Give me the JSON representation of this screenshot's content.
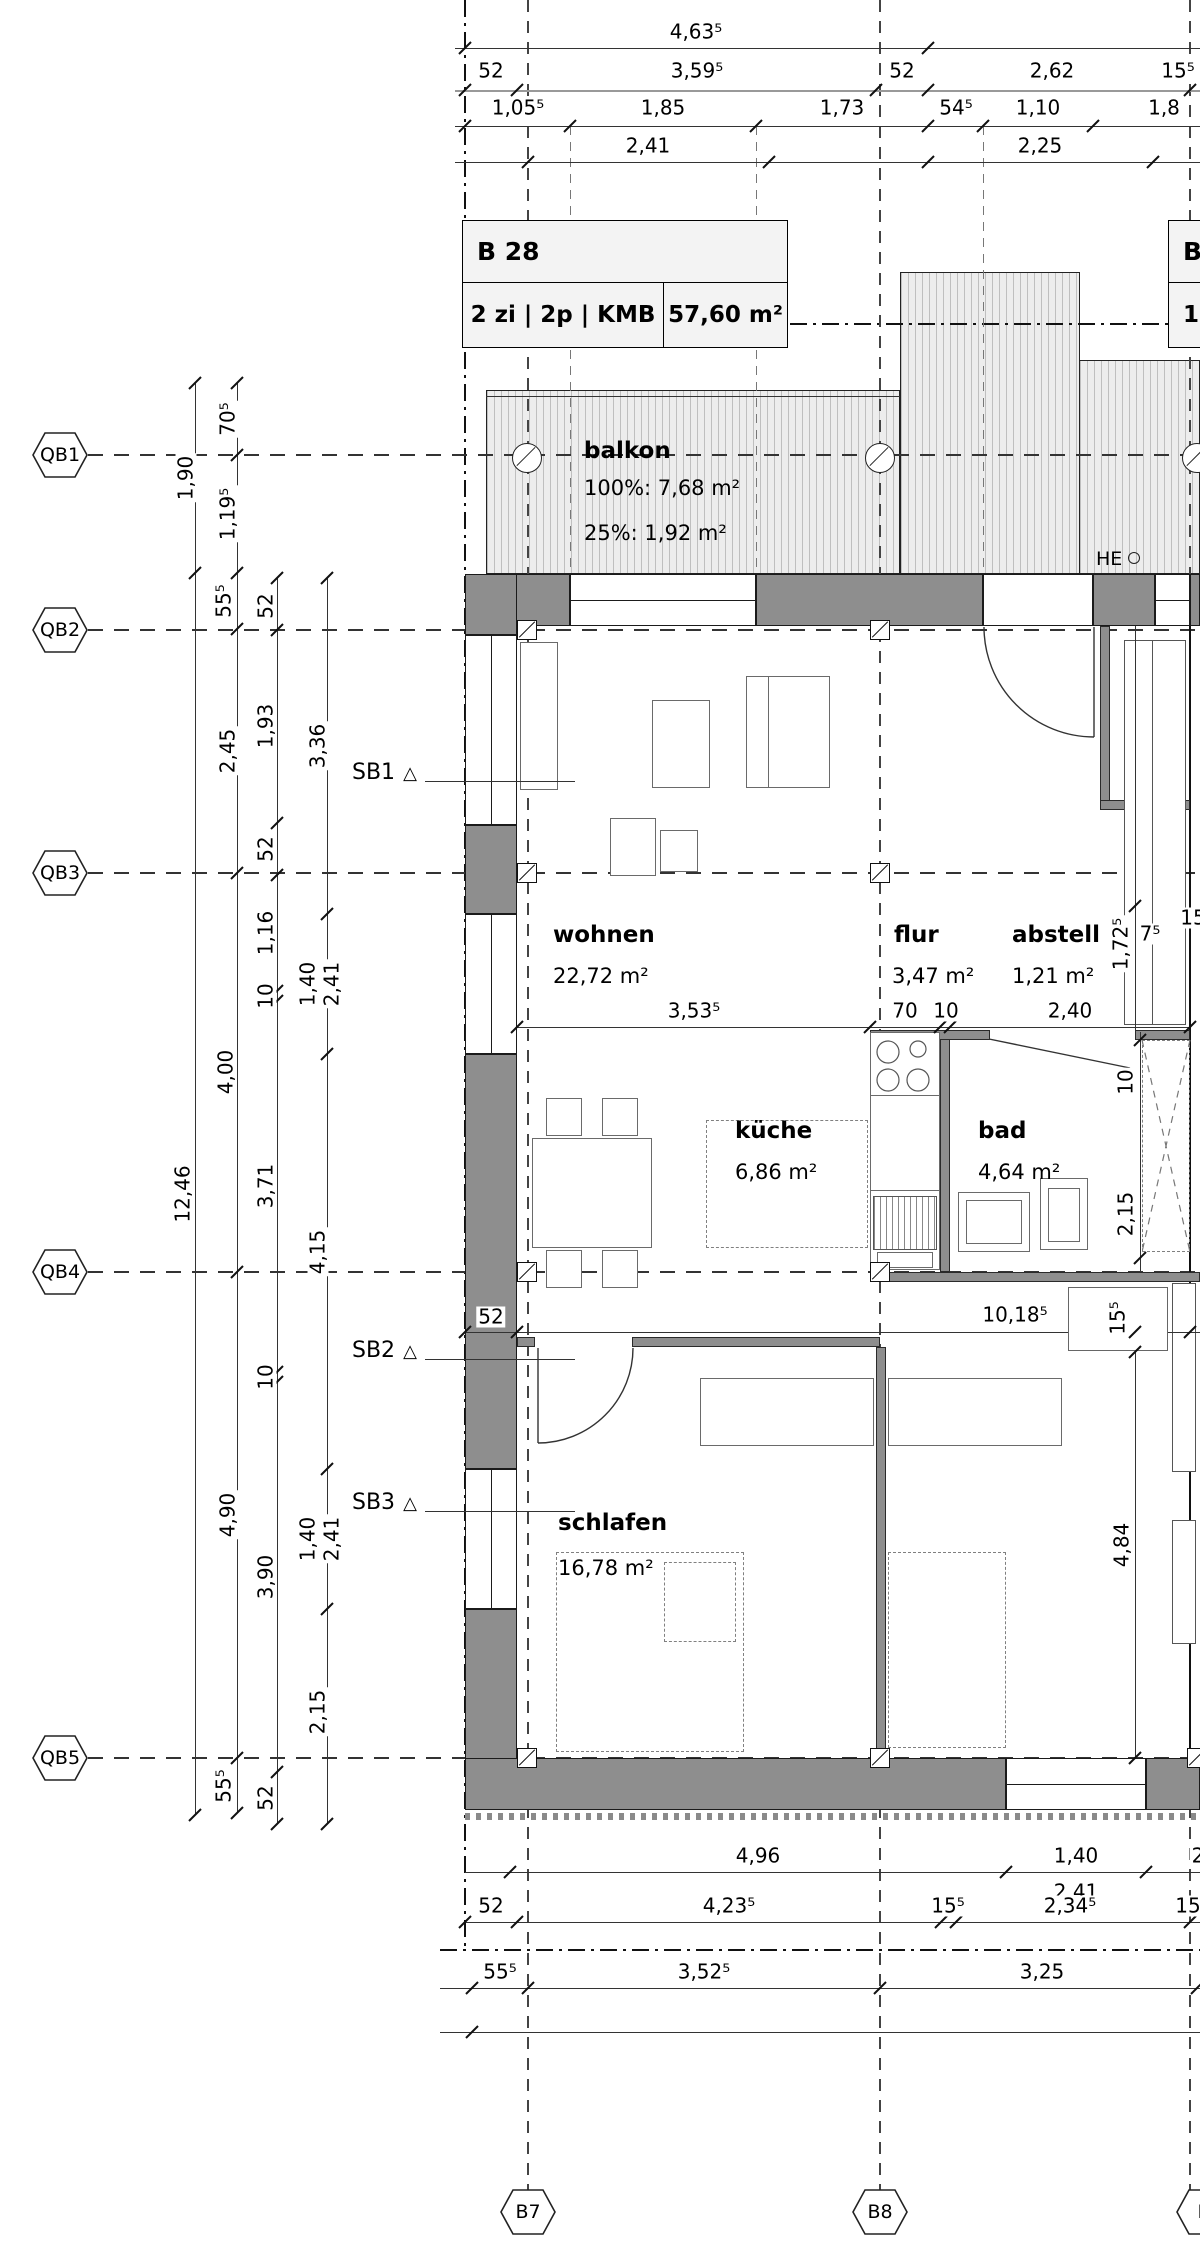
{
  "title_blocks": {
    "b28": {
      "name": "B 28",
      "spec": "2 zi | 2p | KMB",
      "area": "57,60 m²"
    },
    "right": {
      "name": "B",
      "spec": "1 z"
    }
  },
  "rooms": {
    "balkon": {
      "name": "balkon",
      "area_100": "100%: 7,68 m²",
      "area_25": "25%: 1,92 m²"
    },
    "wohnen": {
      "name": "wohnen",
      "area": "22,72 m²"
    },
    "flur": {
      "name": "flur",
      "area": "3,47 m²"
    },
    "abstell": {
      "name": "abstell",
      "area": "1,21 m²"
    },
    "kueche": {
      "name": "küche",
      "area": "6,86 m²"
    },
    "bad": {
      "name": "bad",
      "area": "4,64 m²"
    },
    "schlafen": {
      "name": "schlafen",
      "area": "16,78 m²"
    },
    "he_label": "HE"
  },
  "grid_markers_left": [
    {
      "t": "QB1",
      "x": 60,
      "y": 455
    },
    {
      "t": "QB2",
      "x": 60,
      "y": 630
    },
    {
      "t": "QB3",
      "x": 60,
      "y": 873
    },
    {
      "t": "QB4",
      "x": 60,
      "y": 1272
    },
    {
      "t": "QB5",
      "x": 60,
      "y": 1758
    }
  ],
  "grid_markers_bottom": [
    {
      "t": "B7",
      "x": 528,
      "y": 2212
    },
    {
      "t": "B8",
      "x": 880,
      "y": 2212
    },
    {
      "t": "B",
      "x": 1204,
      "y": 2212
    }
  ],
  "section_markers": [
    {
      "t": "SB1",
      "x": 352,
      "y": 760
    },
    {
      "t": "SB2",
      "x": 352,
      "y": 1338
    },
    {
      "t": "SB3",
      "x": 352,
      "y": 1490
    }
  ],
  "dims_top": [
    {
      "t": "4,63⁵",
      "x": 696,
      "y": 32
    },
    {
      "t": "52",
      "x": 491,
      "y": 71
    },
    {
      "t": "3,59⁵",
      "x": 697,
      "y": 71
    },
    {
      "t": "52",
      "x": 902,
      "y": 71
    },
    {
      "t": "2,62",
      "x": 1052,
      "y": 71
    },
    {
      "t": "15⁵",
      "x": 1178,
      "y": 71
    },
    {
      "t": "1,05⁵",
      "x": 518,
      "y": 108
    },
    {
      "t": "1,85",
      "x": 663,
      "y": 108
    },
    {
      "t": "1,73",
      "x": 842,
      "y": 108
    },
    {
      "t": "54⁵",
      "x": 956,
      "y": 108
    },
    {
      "t": "1,10",
      "x": 1038,
      "y": 108
    },
    {
      "t": "1,8",
      "x": 1164,
      "y": 108
    },
    {
      "t": "2,41",
      "x": 648,
      "y": 146
    },
    {
      "t": "2,25",
      "x": 1040,
      "y": 146
    }
  ],
  "dims_left": [
    {
      "t": "1,90",
      "x": 186,
      "y": 478,
      "rot": true
    },
    {
      "t": "70⁵",
      "x": 228,
      "y": 419,
      "rot": true
    },
    {
      "t": "1,19⁵",
      "x": 228,
      "y": 514,
      "rot": true
    },
    {
      "t": "55⁵",
      "x": 224,
      "y": 601,
      "rot": true
    },
    {
      "t": "52",
      "x": 266,
      "y": 606,
      "rot": true
    },
    {
      "t": "2,45",
      "x": 228,
      "y": 751,
      "rot": true
    },
    {
      "t": "1,93",
      "x": 266,
      "y": 726,
      "rot": true
    },
    {
      "t": "3,36",
      "x": 318,
      "y": 746,
      "rot": true
    },
    {
      "t": "52",
      "x": 266,
      "y": 849,
      "rot": true
    },
    {
      "t": "1,16",
      "x": 266,
      "y": 933,
      "rot": true
    },
    {
      "t": "10",
      "x": 266,
      "y": 996,
      "rot": true
    },
    {
      "t": "1,40",
      "x": 308,
      "y": 984,
      "rot": true
    },
    {
      "t": "2,41",
      "x": 332,
      "y": 984,
      "rot": true
    },
    {
      "t": "4,00",
      "x": 226,
      "y": 1072,
      "rot": true
    },
    {
      "t": "12,46",
      "x": 183,
      "y": 1194,
      "rot": true
    },
    {
      "t": "3,71",
      "x": 266,
      "y": 1186,
      "rot": true
    },
    {
      "t": "4,15",
      "x": 318,
      "y": 1252,
      "rot": true
    },
    {
      "t": "10",
      "x": 266,
      "y": 1377,
      "rot": true
    },
    {
      "t": "4,90",
      "x": 228,
      "y": 1515,
      "rot": true
    },
    {
      "t": "1,40",
      "x": 308,
      "y": 1539,
      "rot": true
    },
    {
      "t": "2,41",
      "x": 332,
      "y": 1539,
      "rot": true
    },
    {
      "t": "3,90",
      "x": 266,
      "y": 1577,
      "rot": true
    },
    {
      "t": "2,15",
      "x": 318,
      "y": 1712,
      "rot": true
    },
    {
      "t": "55⁵",
      "x": 224,
      "y": 1786,
      "rot": true
    },
    {
      "t": "52",
      "x": 266,
      "y": 1798,
      "rot": true
    }
  ],
  "dims_inner": [
    {
      "t": "3,53⁵",
      "x": 694,
      "y": 1011
    },
    {
      "t": "70",
      "x": 905,
      "y": 1011
    },
    {
      "t": "10",
      "x": 946,
      "y": 1011
    },
    {
      "t": "2,40",
      "x": 1070,
      "y": 1011
    },
    {
      "t": "52",
      "x": 491,
      "y": 1317
    },
    {
      "t": "10,18⁵",
      "x": 1015,
      "y": 1315
    },
    {
      "t": "15⁵",
      "x": 1118,
      "y": 1318,
      "rot": true
    },
    {
      "t": "1,72⁵",
      "x": 1121,
      "y": 944,
      "rot": true
    },
    {
      "t": "7⁵",
      "x": 1150,
      "y": 934
    },
    {
      "t": "15⁵",
      "x": 1197,
      "y": 918
    },
    {
      "t": "10",
      "x": 1126,
      "y": 1082,
      "rot": true
    },
    {
      "t": "2,15",
      "x": 1126,
      "y": 1214,
      "rot": true
    },
    {
      "t": "4,84",
      "x": 1122,
      "y": 1545,
      "rot": true
    }
  ],
  "dims_bottom": [
    {
      "t": "4,96",
      "x": 758,
      "y": 1856
    },
    {
      "t": "1,40",
      "x": 1076,
      "y": 1856
    },
    {
      "t": "2",
      "x": 1198,
      "y": 1856
    },
    {
      "t": "2,41",
      "x": 1076,
      "y": 1892
    },
    {
      "t": "52",
      "x": 491,
      "y": 1906
    },
    {
      "t": "4,23⁵",
      "x": 729,
      "y": 1906
    },
    {
      "t": "15⁵",
      "x": 948,
      "y": 1906
    },
    {
      "t": "2,34⁵",
      "x": 1070,
      "y": 1906
    },
    {
      "t": "15⁵",
      "x": 1192,
      "y": 1906
    },
    {
      "t": "55⁵",
      "x": 500,
      "y": 1972
    },
    {
      "t": "3,52⁵",
      "x": 704,
      "y": 1972
    },
    {
      "t": "3,25",
      "x": 1042,
      "y": 1972
    }
  ],
  "ticks": [
    {
      "x": 465,
      "y": 48
    },
    {
      "x": 928,
      "y": 48
    },
    {
      "x": 465,
      "y": 90
    },
    {
      "x": 517,
      "y": 90
    },
    {
      "x": 876,
      "y": 90
    },
    {
      "x": 928,
      "y": 90
    },
    {
      "x": 1190,
      "y": 90
    },
    {
      "x": 465,
      "y": 126
    },
    {
      "x": 570,
      "y": 126
    },
    {
      "x": 756,
      "y": 126
    },
    {
      "x": 928,
      "y": 126
    },
    {
      "x": 983,
      "y": 126
    },
    {
      "x": 1093,
      "y": 126
    },
    {
      "x": 528,
      "y": 162
    },
    {
      "x": 769,
      "y": 162
    },
    {
      "x": 928,
      "y": 162
    },
    {
      "x": 1153,
      "y": 162
    },
    {
      "x": 195,
      "y": 383
    },
    {
      "x": 195,
      "y": 573
    },
    {
      "x": 195,
      "y": 1815
    },
    {
      "x": 237,
      "y": 383
    },
    {
      "x": 237,
      "y": 455
    },
    {
      "x": 237,
      "y": 573
    },
    {
      "x": 237,
      "y": 629
    },
    {
      "x": 237,
      "y": 873
    },
    {
      "x": 237,
      "y": 1272
    },
    {
      "x": 237,
      "y": 1758
    },
    {
      "x": 237,
      "y": 1813
    },
    {
      "x": 277,
      "y": 578
    },
    {
      "x": 277,
      "y": 630
    },
    {
      "x": 277,
      "y": 823
    },
    {
      "x": 277,
      "y": 875
    },
    {
      "x": 277,
      "y": 991
    },
    {
      "x": 277,
      "y": 1001
    },
    {
      "x": 277,
      "y": 1372
    },
    {
      "x": 277,
      "y": 1382
    },
    {
      "x": 277,
      "y": 1772
    },
    {
      "x": 277,
      "y": 1824
    },
    {
      "x": 327,
      "y": 578
    },
    {
      "x": 327,
      "y": 914
    },
    {
      "x": 327,
      "y": 1054
    },
    {
      "x": 327,
      "y": 1469
    },
    {
      "x": 327,
      "y": 1609
    },
    {
      "x": 327,
      "y": 1824
    },
    {
      "x": 517,
      "y": 1027
    },
    {
      "x": 870,
      "y": 1027
    },
    {
      "x": 940,
      "y": 1027
    },
    {
      "x": 950,
      "y": 1027
    },
    {
      "x": 1190,
      "y": 1027
    },
    {
      "x": 465,
      "y": 1332
    },
    {
      "x": 517,
      "y": 1332
    },
    {
      "x": 1135,
      "y": 1332
    },
    {
      "x": 1190,
      "y": 1332
    },
    {
      "x": 1140,
      "y": 1040
    },
    {
      "x": 1140,
      "y": 1258
    },
    {
      "x": 1135,
      "y": 906
    },
    {
      "x": 1135,
      "y": 1352
    },
    {
      "x": 1135,
      "y": 1758
    },
    {
      "x": 510,
      "y": 1872
    },
    {
      "x": 1006,
      "y": 1872
    },
    {
      "x": 1146,
      "y": 1872
    },
    {
      "x": 465,
      "y": 1922
    },
    {
      "x": 517,
      "y": 1922
    },
    {
      "x": 941,
      "y": 1922
    },
    {
      "x": 956,
      "y": 1922
    },
    {
      "x": 1190,
      "y": 1922
    },
    {
      "x": 472,
      "y": 1988
    },
    {
      "x": 528,
      "y": 1988
    },
    {
      "x": 880,
      "y": 1988
    },
    {
      "x": 1197,
      "y": 1988
    },
    {
      "x": 472,
      "y": 2032
    }
  ],
  "columns": [
    {
      "x": 527,
      "y": 630
    },
    {
      "x": 880,
      "y": 630
    },
    {
      "x": 527,
      "y": 873
    },
    {
      "x": 880,
      "y": 873
    },
    {
      "x": 527,
      "y": 1272
    },
    {
      "x": 880,
      "y": 1272
    },
    {
      "x": 527,
      "y": 1758
    },
    {
      "x": 880,
      "y": 1758
    },
    {
      "x": 1197,
      "y": 1758
    }
  ],
  "drains": [
    {
      "x": 527,
      "y": 458
    },
    {
      "x": 880,
      "y": 458
    },
    {
      "x": 1197,
      "y": 458
    }
  ]
}
